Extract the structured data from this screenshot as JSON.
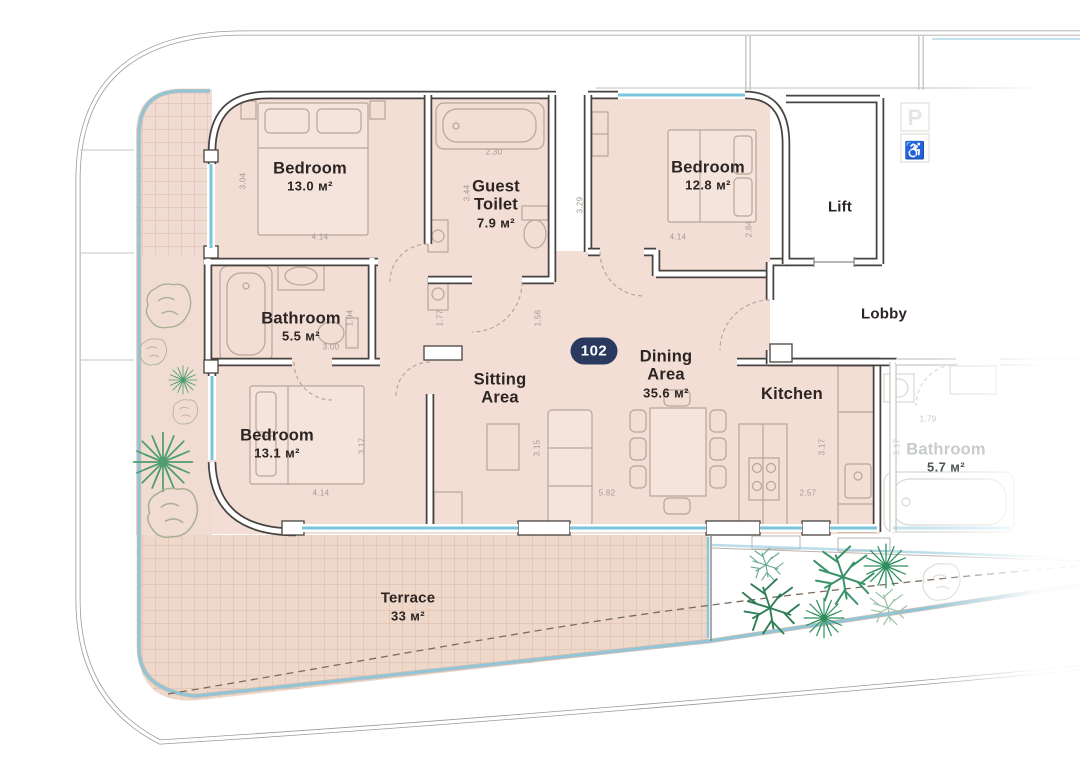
{
  "unit": {
    "number": "102"
  },
  "rooms": {
    "bedroom_top_left": {
      "name": "Bedroom",
      "area": "13.0 м²"
    },
    "guest_toilet": {
      "name": "Guest Toilet",
      "area": "7.9 м²"
    },
    "bedroom_top_right": {
      "name": "Bedroom",
      "area": "12.8 м²"
    },
    "lift": {
      "name": "Lift"
    },
    "lobby": {
      "name": "Lobby"
    },
    "bathroom": {
      "name": "Bathroom",
      "area": "5.5 м²"
    },
    "bedroom_bottom": {
      "name": "Bedroom",
      "area": "13.1 м²"
    },
    "sitting_area": {
      "name": "Sitting Area"
    },
    "dining_area": {
      "name": "Dining Area",
      "area": "35.6 м²"
    },
    "kitchen": {
      "name": "Kitchen"
    },
    "neighbor_bathroom": {
      "name": "Bathroom",
      "area": "5.7 м²"
    },
    "terrace": {
      "name": "Terrace",
      "area": "33 м²"
    }
  },
  "dims": [
    "3.04",
    "4.14",
    "2.30",
    "3.44",
    "3.29",
    "4.14",
    "2.84",
    "1.94",
    "3.00",
    "1.77",
    "1.56",
    "3.17",
    "4.14",
    "3.15",
    "5.82",
    "3.17",
    "2.57",
    "1.79",
    "3.17"
  ],
  "icons": {
    "parking": "P",
    "wheelchair": "♿"
  },
  "colors": {
    "unit_fill": "#f2ded5",
    "terrace_fill": "#eed8ca",
    "tile_line": "#dcb9ab",
    "window_blue": "#7cc4dc",
    "perimeter_blue": "#8cc6da",
    "badge_bg": "#2a3a5e",
    "badge_text": "#ffffff",
    "wall": "#474340",
    "label_text": "#2b2423",
    "dim_text": "#a29a92",
    "tree_green": "#3c9268",
    "faded_text": "#c7cccb"
  }
}
